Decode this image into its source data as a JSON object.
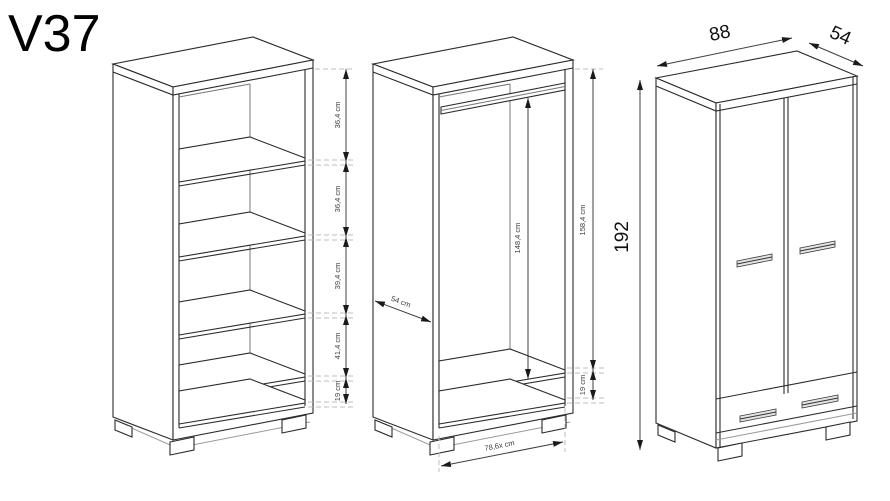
{
  "title": "V37",
  "colors": {
    "line": "#2a2a2a",
    "dash": "#bdbdbd",
    "dim": "#3f3f3f"
  },
  "left_view": {
    "dims": [
      "36,4 cm",
      "36,4 cm",
      "39,4 cm",
      "41,4 cm",
      "19 cm"
    ]
  },
  "middle_view": {
    "rail_height": "148,4 cm",
    "interior_height": "158,4 cm",
    "bottom_gap": "19 cm",
    "side_depth": "54 cm",
    "interior_width": "78,6x cm"
  },
  "right_view": {
    "width": "88",
    "depth": "54",
    "height": "192"
  }
}
